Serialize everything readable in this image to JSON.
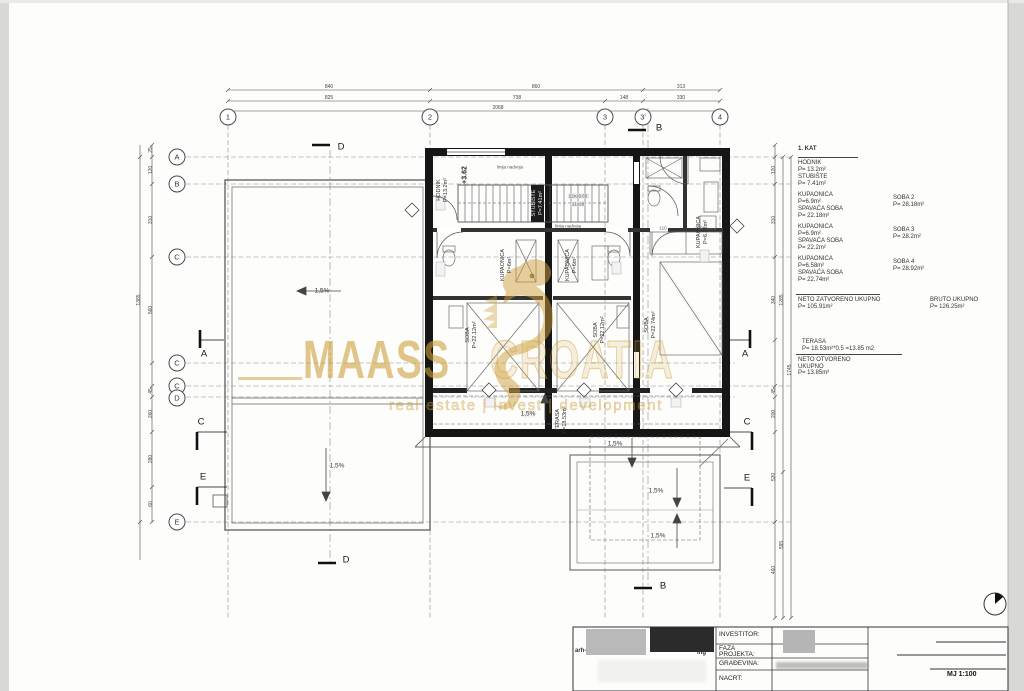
{
  "watermark": {
    "brand_bold": "MAASS",
    "brand_light": "CROATIA",
    "tagline": "real estate | invest | development",
    "color": "#cea03a",
    "logo": "seahorse"
  },
  "grid_axes": {
    "top": [
      "1",
      "2",
      "3",
      "3'",
      "4"
    ],
    "left": [
      "A",
      "B",
      "C",
      "C",
      "C",
      "D",
      "E"
    ]
  },
  "sections": {
    "a": "A",
    "b": "B",
    "c": "C",
    "d": "D",
    "e": "E"
  },
  "dimensions": {
    "top_row1": [
      "840",
      "860",
      "313"
    ],
    "top_row2": [
      "825",
      "738",
      "148",
      "330"
    ],
    "top_total": "2068",
    "left_col": [
      "25",
      "120",
      "310",
      "560",
      "45",
      "260",
      "280",
      "60"
    ],
    "left_total": "1385",
    "right_col": [
      "120",
      "310",
      "340",
      "45",
      "200",
      "520",
      "460"
    ],
    "right_mid": [
      "1285",
      "595"
    ],
    "right_total": "1745"
  },
  "rooms": {
    "level_mark": "+3.62",
    "hodnik": {
      "name": "HODNIK",
      "area": "P=13.2m²"
    },
    "stubiste": {
      "name": "STUBIŠTE",
      "area": "P=7.41m²"
    },
    "stairs_count": "22x16.65",
    "stairs_count2": "21x28",
    "lintel_line": "linija nadvoja",
    "kupaonica1": {
      "name": "KUPAONICA",
      "area": "P=6m²"
    },
    "kupaonica2": {
      "name": "KUPAONICA",
      "area": "P=6m²"
    },
    "kupaonica3": {
      "name": "KUPAONICA",
      "area": "P=6.18m²"
    },
    "soba1": {
      "name": "SOBA",
      "area": "P=22.12m²"
    },
    "soba2": {
      "name": "SOBA",
      "area": "P=22.12m²"
    },
    "soba3": {
      "name": "SOBA",
      "area": "P=22.74m²"
    },
    "terasa": {
      "name": "TERASA",
      "area": "P=18.53m²"
    },
    "slope": "1,5%",
    "closet_w1": "110",
    "closet_w2": "210"
  },
  "legend": {
    "floor_title": "1.   KAT",
    "hodnik": {
      "name": "HODNIK",
      "area": "P= 13.2m²"
    },
    "stubiste": {
      "name": "STUBIŠTE",
      "area": "P= 7.41m²"
    },
    "items": [
      {
        "name": "KUPAONICA",
        "area": "P=6.9m²"
      },
      {
        "name": "SPAVAĆA SOBA",
        "area": "P= 22.18m²"
      },
      {
        "name": "KUPAONICA",
        "area": "P=6.9m²"
      },
      {
        "name": "SPAVAĆA SOBA",
        "area": "P= 22.2m²"
      },
      {
        "name": "KUPAONICA",
        "area": "P=6.58m²"
      },
      {
        "name": "SPAVAĆA SOBA",
        "area": "P= 22.74m²"
      }
    ],
    "rooms_right": [
      {
        "name": "SOBA 2",
        "area": "P= 28.18m²"
      },
      {
        "name": "SOBA 3",
        "area": "P= 28.2m²"
      },
      {
        "name": "SOBA 4",
        "area": "P= 28.92m²"
      }
    ],
    "neto_zatvoreno": {
      "name": "NETO ZATVORENO UKUPNO",
      "area": "P= 105.91m²"
    },
    "bruto": {
      "name": "BRUTO UKUPNO",
      "area": "P= 126.25m²"
    },
    "terasa": {
      "name": "TERASA",
      "area": "P= 18.53m²*0.5 =13.85 m2"
    },
    "neto_otvoreno": {
      "line1": "NETO OTVORENO",
      "line2": "UKUPNO",
      "area": "P= 13.85m²"
    }
  },
  "title_block": {
    "investitor_label": "INVESTITOR:",
    "faza_label1": "FAZA",
    "faza_label2": "PROJEKTA:",
    "gradjevina_label": "GRAĐEVINA:",
    "nacrt_label": "NACRT:",
    "scale": "MJ 1:100",
    "stamp_left": "arh-",
    "stamp_right": "ing"
  }
}
